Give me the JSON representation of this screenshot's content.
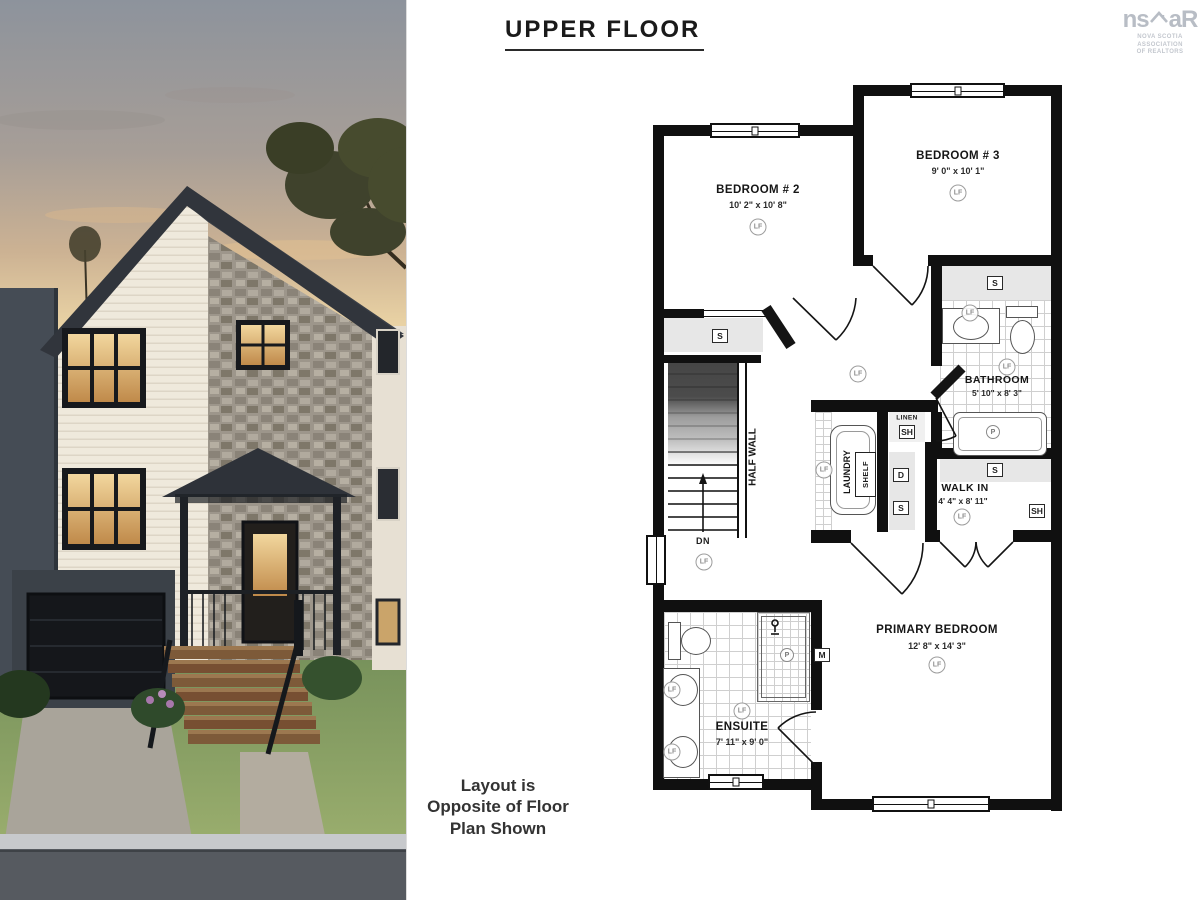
{
  "header": {
    "title": "UPPER FLOOR"
  },
  "logo": {
    "left": "ns",
    "right": "aR",
    "tagline1": "NOVA SCOTIA ASSOCIATION",
    "tagline2": "OF REALTORS"
  },
  "note": {
    "line1": "Layout is",
    "line2": "Opposite of Floor",
    "line3": "Plan Shown"
  },
  "plan": {
    "rooms": [
      {
        "name": "BEDROOM # 2",
        "dims": "10' 2\" x 10' 8\""
      },
      {
        "name": "BEDROOM # 3",
        "dims": "9' 0\" x 10' 1\""
      },
      {
        "name": "BATHROOM",
        "dims": "5' 10\" x 8' 3\""
      },
      {
        "name": "WALK IN",
        "dims": "4' 4\" x 8' 11\""
      },
      {
        "name": "PRIMARY BEDROOM",
        "dims": "12' 8\" x 14' 3\""
      },
      {
        "name": "ENSUITE",
        "dims": "7' 11\" x 9' 0\""
      }
    ],
    "labels": {
      "linen": "LINEN",
      "laundry": "LAUNDRY",
      "shelf_closet": "SHELF",
      "half_wall": "HALF WALL",
      "down": "DN"
    },
    "markers": {
      "light": "LF",
      "plumbing": "P",
      "shelf": "S",
      "shelf2": "SH",
      "d": "D",
      "m": "M"
    },
    "colors": {
      "wall": "#101010",
      "closet_fill": "#e7e7e7"
    }
  }
}
